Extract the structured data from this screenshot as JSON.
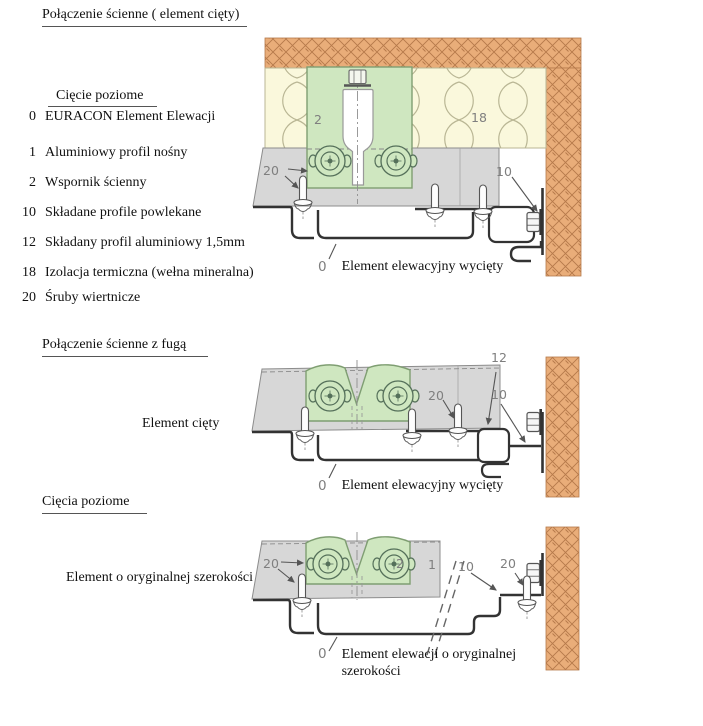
{
  "title": "Połączenie ścienne ( element cięty)",
  "legend": {
    "heading": "Cięcie poziome",
    "items": [
      {
        "num": "0",
        "label": "EURACON Element Elewacji"
      },
      {
        "num": "1",
        "label": "Aluminiowy profil nośny"
      },
      {
        "num": "2",
        "label": "Wspornik ścienny"
      },
      {
        "num": "10",
        "label": "Składane profile powlekane"
      },
      {
        "num": "12",
        "label": "Składany profil aluminiowy 1,5mm"
      },
      {
        "num": "18",
        "label": "Izolacja termiczna (wełna mineralna)"
      },
      {
        "num": "20",
        "label": "Śruby wiertnicze"
      }
    ]
  },
  "middle_section": {
    "heading": "Połączenie ścienne z fugą",
    "side_label": "Element cięty"
  },
  "bottom_section": {
    "heading": "Cięcia poziome",
    "side_label": "Element o oryginalnej szerokości"
  },
  "captions": {
    "top": {
      "num": "0",
      "text": "Element elewacyjny wycięty"
    },
    "middle": {
      "num": "0",
      "text": "Element elewacyjny wycięty"
    },
    "bottom": {
      "num": "0",
      "line1": "Element elewacji o oryginalnej",
      "line2": "szerokości"
    }
  },
  "part_labels": {
    "top": {
      "bracket": "2",
      "insulation": "18",
      "screws": "20",
      "wall_profile": "10"
    },
    "middle": {
      "screws": "20",
      "alu_profile": "12",
      "wall_profile": "10"
    },
    "bottom": {
      "screws_left": "20",
      "bracket": "2",
      "support_profile": "1",
      "wall_profile": "10",
      "screws_right": "20"
    }
  },
  "colors": {
    "brick_fill": "#e9ad79",
    "brick_hatch": "#b5794a",
    "insulation_fill": "#faf8dc",
    "insulation_line": "#b9b694",
    "bracket_fill": "#cfe7c0",
    "bracket_line": "#7f9e72",
    "profile_fill": "#d7d7d7",
    "profile_edge": "#8c8c8c",
    "steel_line": "#333333",
    "leader_line": "#555555"
  }
}
